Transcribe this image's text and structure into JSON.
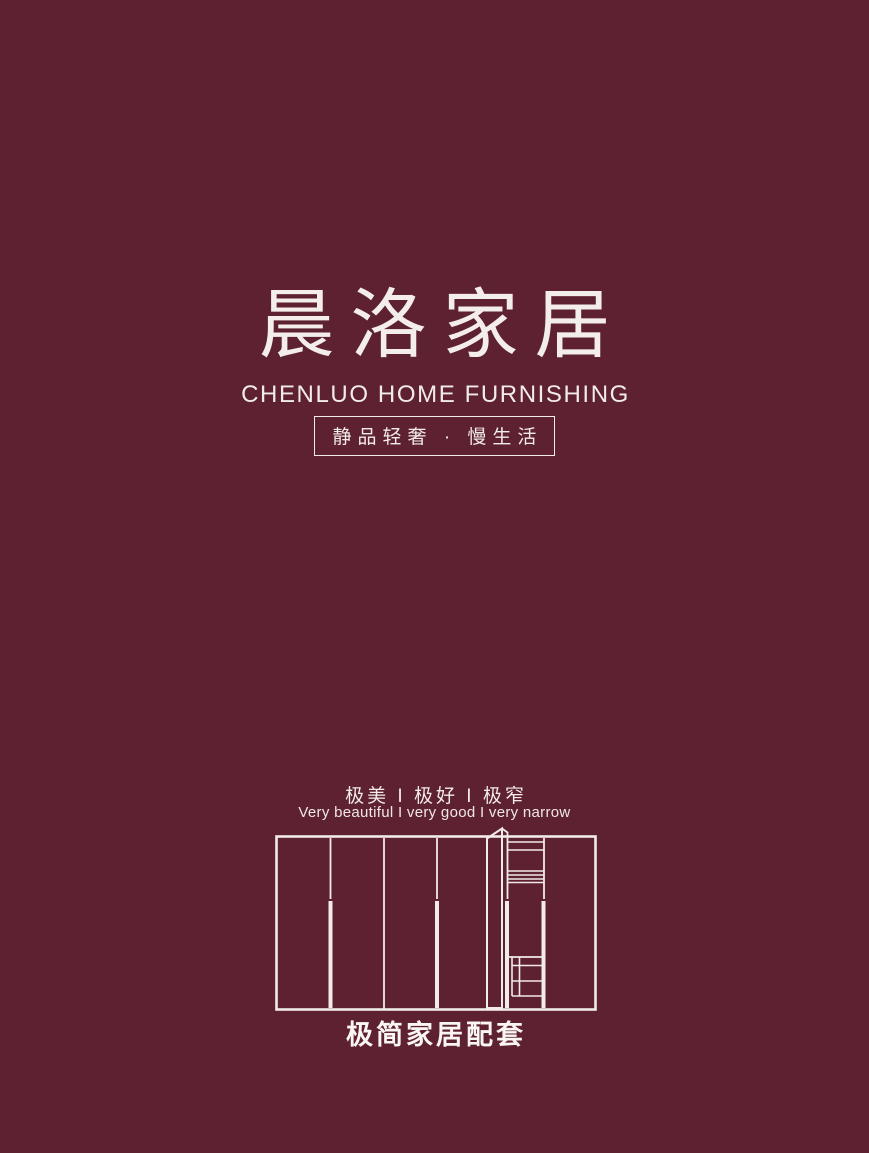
{
  "page": {
    "background_color": "#5e2131",
    "foreground_color": "#f1ebe9"
  },
  "brand": {
    "logo": "晨洛家居",
    "name_en": "CHENLUO HOME FURNISHING",
    "tagline": "静品轻奢 · 慢生活"
  },
  "slogan": {
    "cn": "极美 I 极好 I 极窄",
    "en": "Very beautiful I very good I very narrow"
  },
  "illustration": {
    "name": "wardrobe-line-drawing"
  },
  "footer": {
    "title": "极简家居配套"
  }
}
